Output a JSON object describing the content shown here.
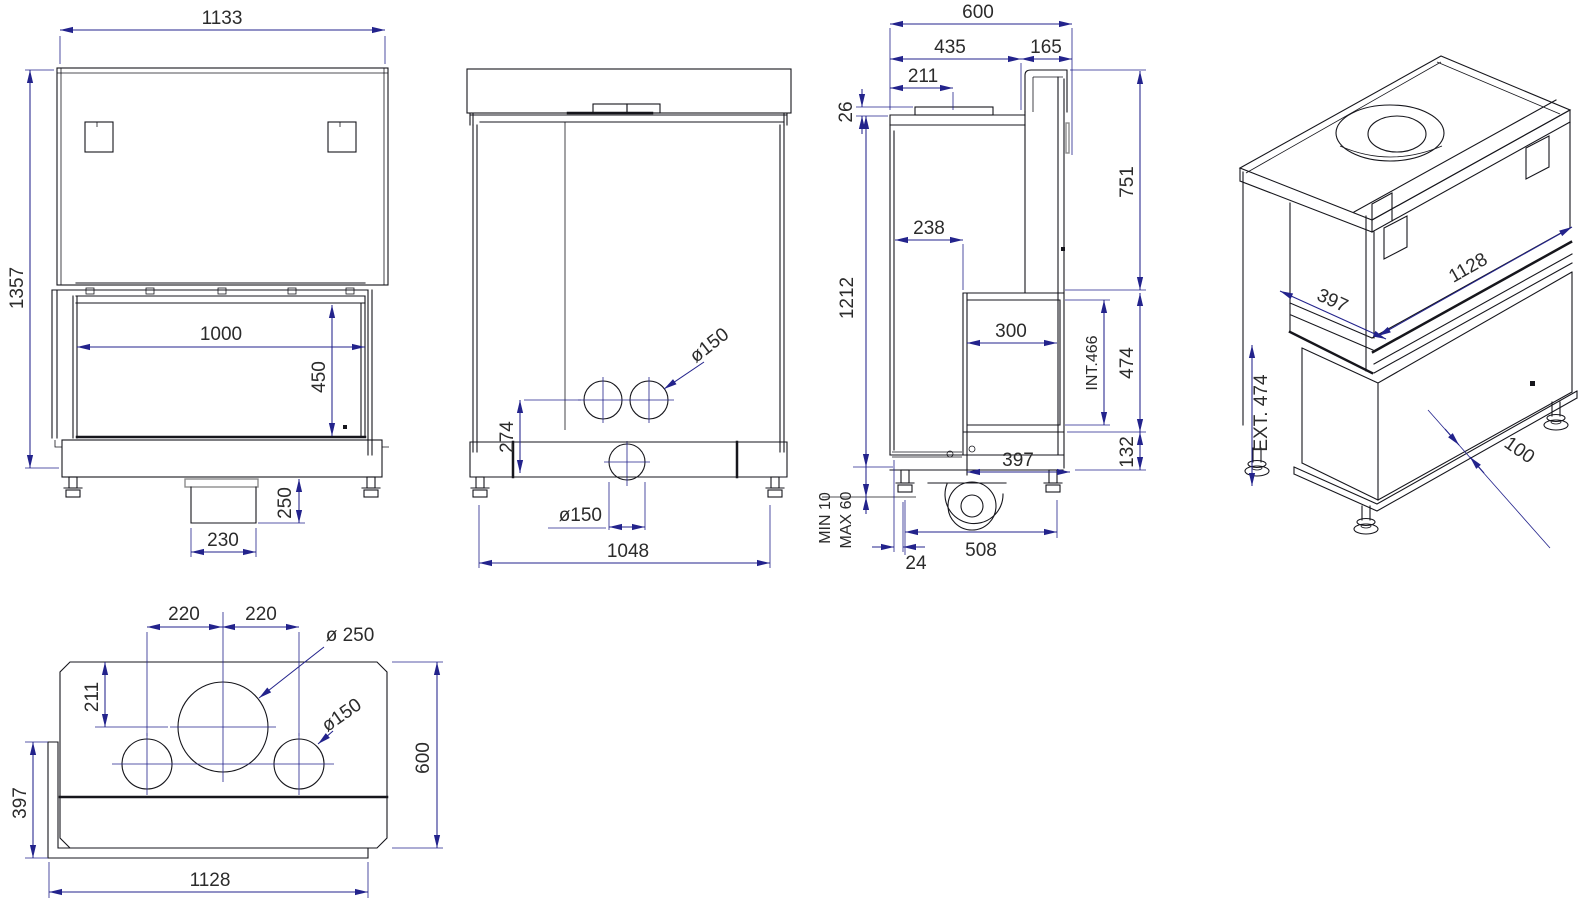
{
  "drawing": {
    "type": "technical-dimension-drawing",
    "subject": "corner fireplace insert - five orthographic and isometric views",
    "colors": {
      "geometry_line": "#16161c",
      "dimension_line": "#23238c",
      "dimension_text": "#2b2b2b",
      "background": "#ffffff"
    },
    "views": {
      "front": {
        "label": "front-view",
        "dims": {
          "overall_width": "1133",
          "overall_height": "1357",
          "glass_width": "1000",
          "glass_height": "450",
          "pedestal_height": "250",
          "pedestal_width": "230"
        }
      },
      "rear": {
        "label": "rear-view",
        "dims": {
          "connector_height": "274",
          "upper_duct_diameter": "ø150",
          "lower_duct_diameter": "ø150",
          "base_width": "1048"
        }
      },
      "side": {
        "label": "side-view",
        "dims": {
          "total_depth": "600",
          "front_depth": "435",
          "back_depth": "165",
          "flue_offset": "211",
          "collar_height": "26",
          "upper_height": "751",
          "total_height": "1212",
          "recess_depth": "238",
          "glass_width": "300",
          "glass_inner_height": "INT.466",
          "glass_outer_height": "474",
          "base_height": "132",
          "glass_depth": "397",
          "foot_min": "MIN 10",
          "foot_max": "MAX 60",
          "foot_offset": "24",
          "foot_spacing": "508"
        }
      },
      "iso": {
        "label": "isometric-view",
        "dims": {
          "glass_front_width": "1128",
          "glass_side_depth": "397",
          "glass_outer_height": "EXT. 474",
          "base_height": "100"
        }
      },
      "top": {
        "label": "top-view",
        "dims": {
          "flue_left_offset": "220",
          "flue_right_offset": "220",
          "flue_diameter": "ø 250",
          "flue_back_offset": "211",
          "duct_diameter": "ø150",
          "glass_side_depth": "397",
          "total_depth": "600",
          "glass_front_width": "1128"
        }
      }
    }
  }
}
